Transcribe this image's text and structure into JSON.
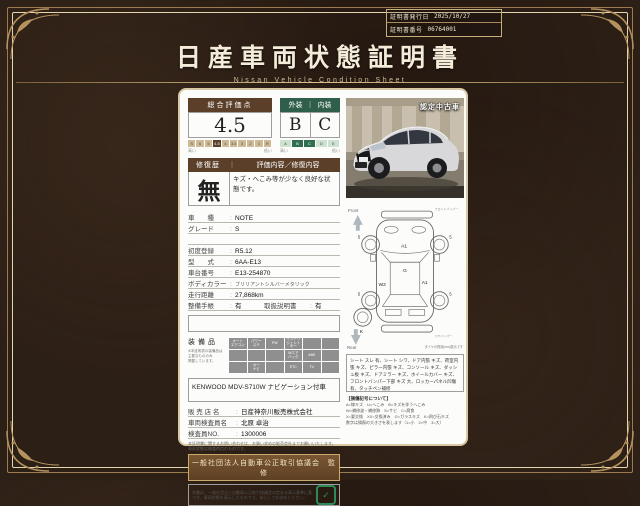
{
  "cert": {
    "issue_label": "証明書発行日",
    "issue_date": "2025/10/27",
    "number_label": "証明書番号",
    "number": "06764001"
  },
  "header": {
    "title": "日産車両状態証明書",
    "subtitle": "Nissan  Vehicle  Condition  Sheet"
  },
  "photo": {
    "badge": "認定中古車"
  },
  "evaluation": {
    "score_label": "総合評価点",
    "exterior_label": "外装",
    "separator": "｜",
    "interior_label": "内装",
    "score": "4.5",
    "exterior_grade": "B",
    "interior_grade": "C",
    "score_scale": [
      "S",
      "6",
      "5",
      "4.5",
      "4",
      "3.5",
      "3",
      "2",
      "1",
      "R"
    ],
    "grade_scale": [
      "A",
      "B",
      "C",
      "D",
      "E"
    ],
    "high_label": "高い",
    "low_label": "低い"
  },
  "repair": {
    "header_left": "修復歴",
    "header_sep": "｜",
    "header_right": "評価内容／修復内容",
    "value": "無",
    "description": "キズ・へこみ等が少なく良好な状態です。"
  },
  "specs": {
    "rows": [
      {
        "label": "車　　種",
        "value": "NOTE"
      },
      {
        "label": "グレード",
        "value": "S"
      },
      {
        "label": "",
        "value": ""
      },
      {
        "label": "初度登録",
        "value": "R5.12"
      },
      {
        "label": "型　　式",
        "value": "6AA-E13"
      },
      {
        "label": "車台番号",
        "value": "E13-254870"
      },
      {
        "label": "ボディカラー",
        "value": "ブリリアントシルバーメタリック"
      },
      {
        "label": "走行距離",
        "value": "27,868km"
      }
    ],
    "maintenance_label": "整備手帳",
    "maintenance_value": "有",
    "manual_label": "取扱説明書",
    "manual_value": "有"
  },
  "equipment": {
    "label": "装備品",
    "note": "※本証明書の装備品は\n主要なもののみ\n掲載しています。",
    "cells": [
      "オート\nエアコン",
      "パワー\nステ",
      "PW",
      "インテリ\nジェント\nキー",
      "",
      "",
      "",
      "",
      "",
      "Wエア\nバッグ",
      "ABS",
      "",
      "",
      "カー\nナビ",
      "",
      "ETC",
      "TV",
      ""
    ],
    "audio": "KENWOOD  MDV-S710W  ナビゲーション付車"
  },
  "dealer": {
    "rows": [
      {
        "label": "販 売 店 名",
        "value": "日産神奈川販売株式会社"
      },
      {
        "label": "車両検査員名",
        "value": "北原 卓治"
      },
      {
        "label": "検査員NO.",
        "value": "1300006"
      }
    ],
    "notes": [
      "本証明書に関するお問い合わせは、お買い求めの販売会社までお願いいたします。",
      "車両状態は検査時点のものです。"
    ]
  },
  "council": {
    "banner": "一般社団法人自動車公正取引協議会　監修",
    "text": "本書は、一般社団法人自動車公正取引協議会の定める表示基準に基づき、車両状態を表示したものです。安心してお求めください。",
    "seal": "✓"
  },
  "diagram": {
    "front_label": "Front",
    "rear_label": "Rear",
    "front_bumper": "フロントバンパー",
    "rear_bumper": "リヤバンパー",
    "codes": {
      "hood": "A1",
      "glass": "G",
      "left": "W2",
      "right": "A1",
      "spare": "K"
    },
    "tires": [
      "5",
      "5",
      "5",
      "5"
    ],
    "tread_note": "タイヤの残溝(mm)表示です"
  },
  "damage": {
    "text": "シート スレ 有、シート シワ、ドア内張 キズ、荷室内張 キズ、ピラー内張 キズ、コンソール キズ、ダッシュ板 キズ、ドアミラー キズ、ホイールカバー キズ、フロントバンパー下部 キズ 大、ロッカーパネル凹傷有、タッチペン補修",
    "legend_title": "【損傷記号について】",
    "legend": [
      "A=線キズ　U=へこみ　B=キズを伴うへこみ",
      "W=補修波・補修跡　S=サビ　C=腐食",
      "X=要交換　XX=交換済み　G=ガラスキズ　K=飛び石キズ",
      "数字は損傷の大きさを表します（1=小　2=中　3=大）"
    ]
  }
}
